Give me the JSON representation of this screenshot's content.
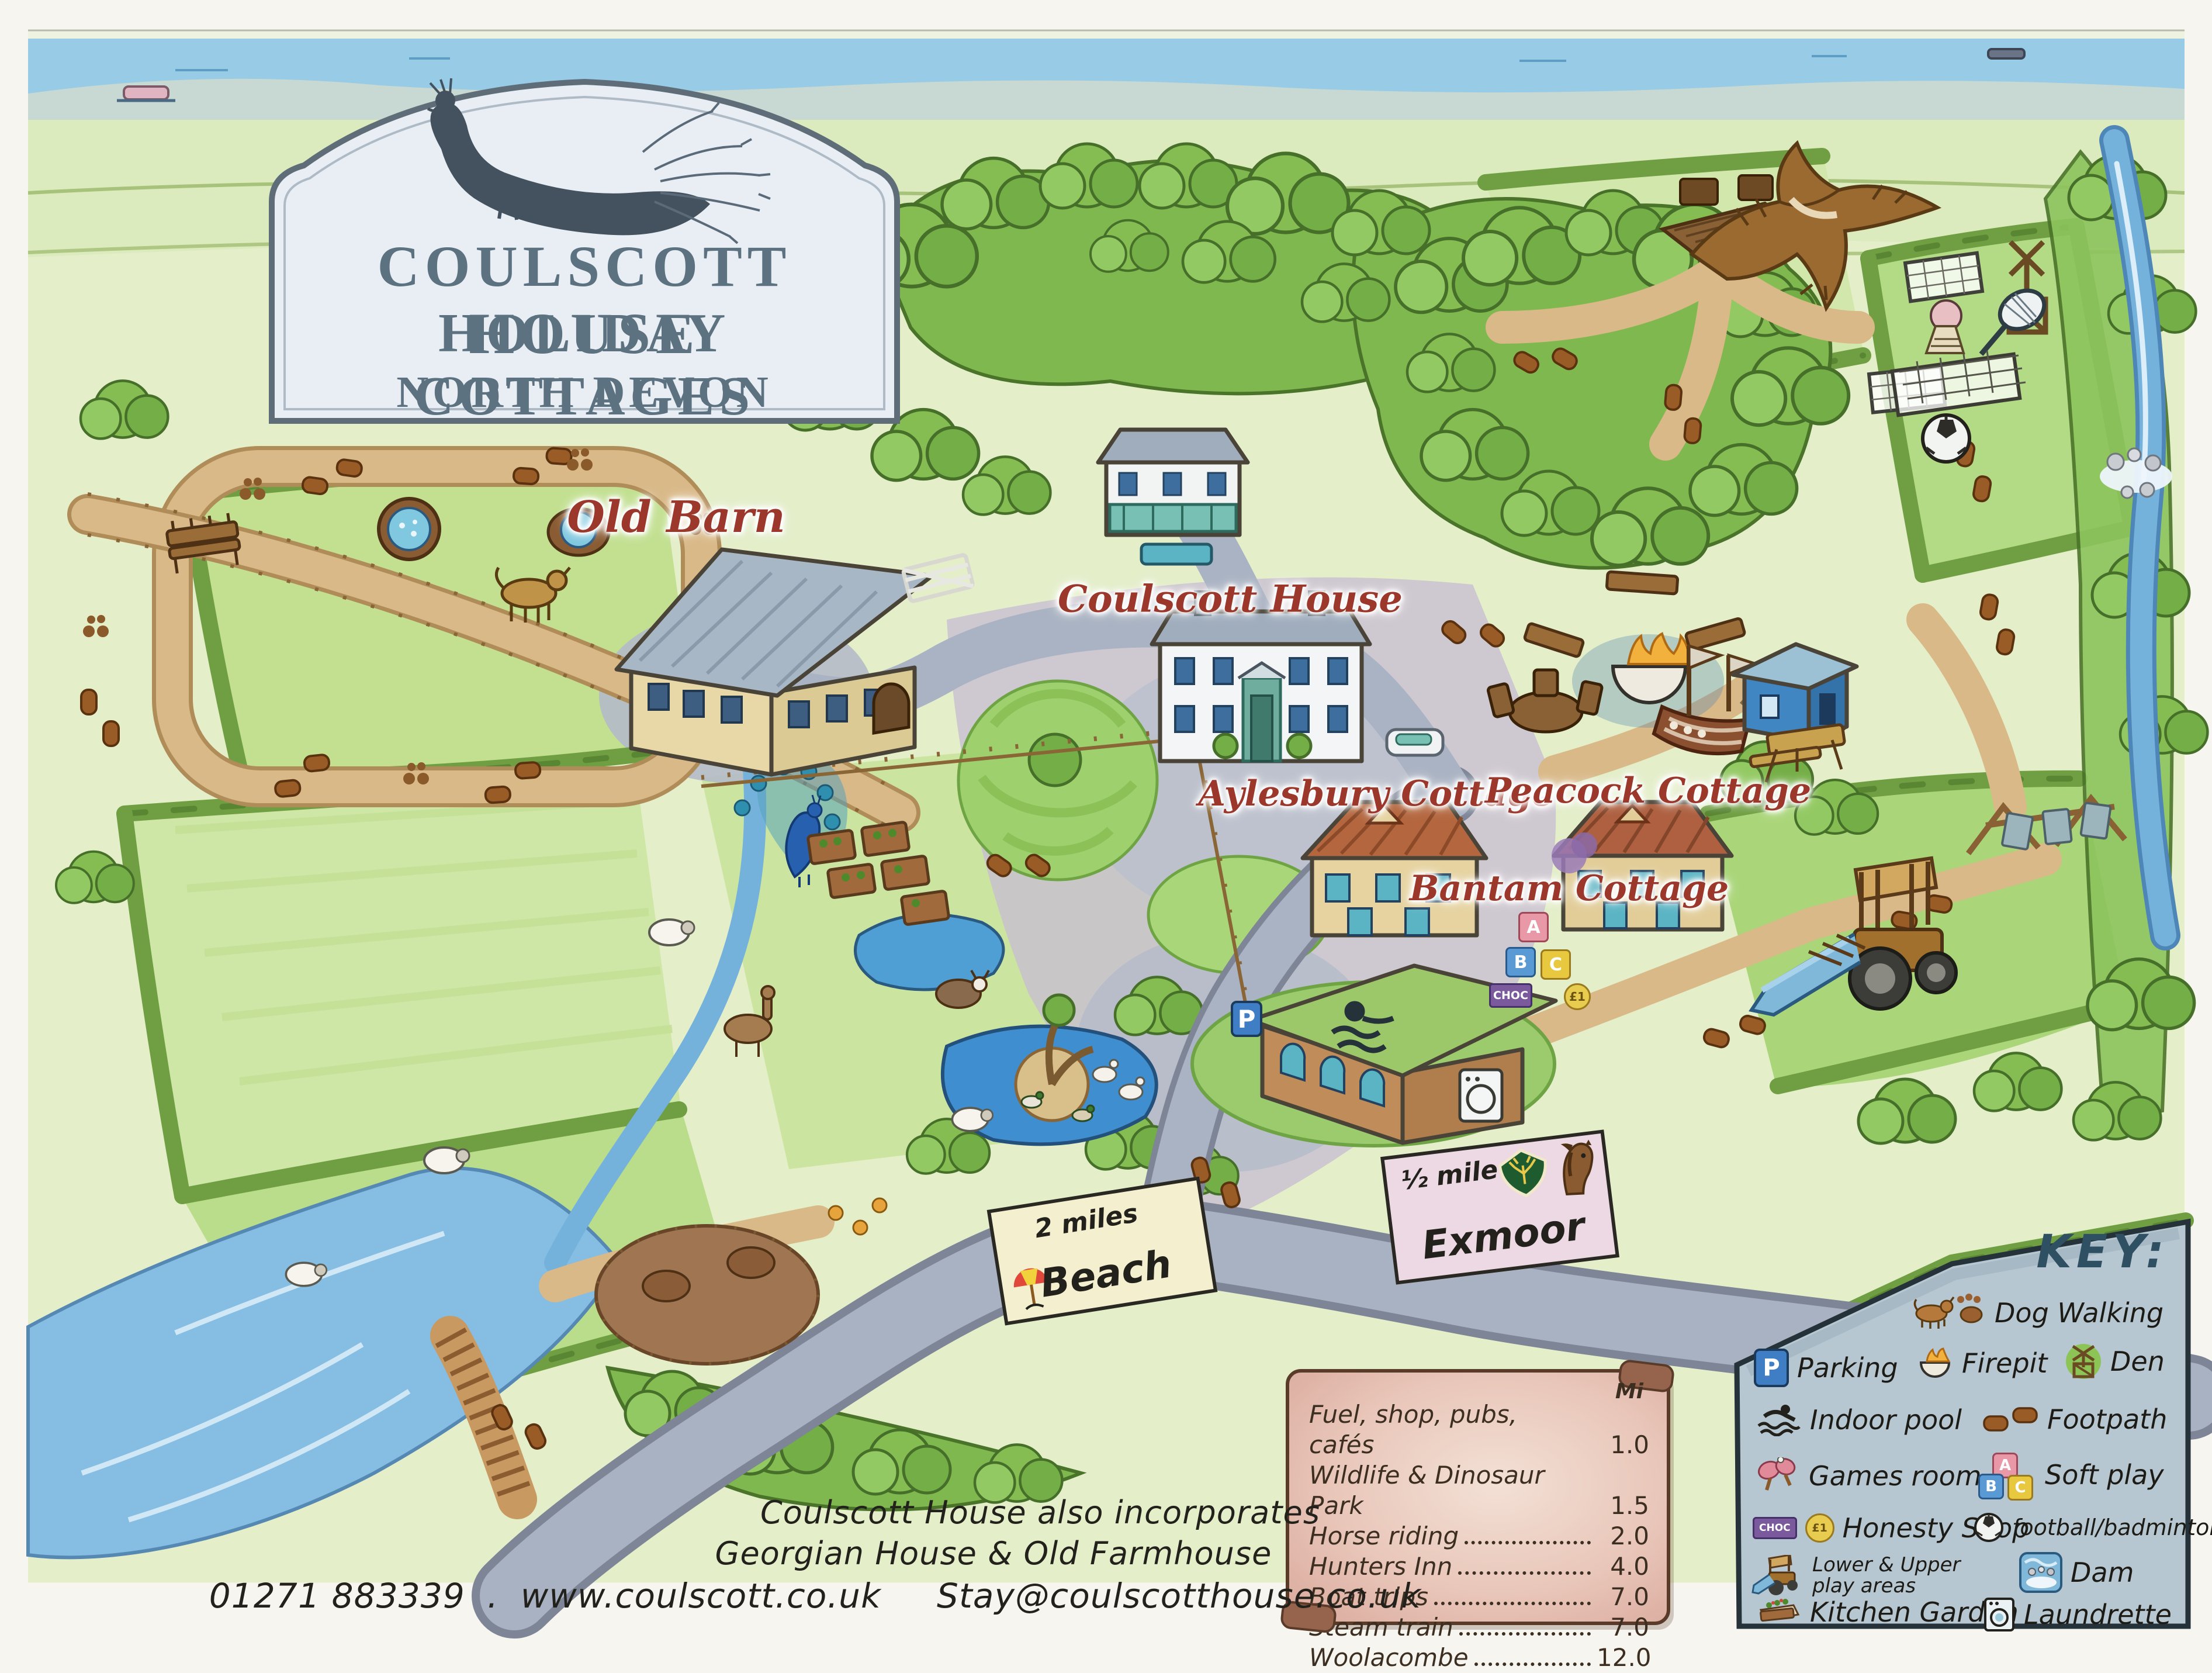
{
  "sign": {
    "title_line1": "COULSCOTT HOUSE",
    "title_line2": "HOLIDAY COTTAGES",
    "title_line3": "NORTH DEVON"
  },
  "map_labels": {
    "old_barn": "Old Barn",
    "coulscott_house": "Coulscott House",
    "aylesbury_cottage": "Aylesbury Cottage",
    "peacock_cottage": "Peacock Cottage",
    "bantam_cottage": "Bantam Cottage"
  },
  "road_signs": {
    "beach": {
      "distance": "2 miles",
      "name": "Beach"
    },
    "exmoor": {
      "distance": "½ mile",
      "name": "Exmoor"
    }
  },
  "map_marks": {
    "parking_letter": "P",
    "block_a": "A",
    "block_b": "B",
    "block_c": "C",
    "choc": "CHOC",
    "coin": "£1"
  },
  "distances": {
    "unit_header": "Mi",
    "items": [
      {
        "name": "Fuel, shop, pubs, cafés",
        "miles": "1.0"
      },
      {
        "name": "Wildlife & Dinosaur Park",
        "miles": "1.5"
      },
      {
        "name": "Horse riding",
        "miles": "2.0"
      },
      {
        "name": "Hunters Inn",
        "miles": "4.0"
      },
      {
        "name": "Boat trips",
        "miles": "7.0"
      },
      {
        "name": "Steam train",
        "miles": "7.0"
      },
      {
        "name": "Woolacombe",
        "miles": "12.0"
      }
    ]
  },
  "key": {
    "title": "KEY:",
    "items": [
      {
        "icon": "dog-walking-icon",
        "label": "Dog Walking"
      },
      {
        "icon": "parking-icon",
        "label": "Parking"
      },
      {
        "icon": "firepit-icon",
        "label": "Firepit"
      },
      {
        "icon": "den-icon",
        "label": "Den"
      },
      {
        "icon": "indoor-pool-icon",
        "label": "Indoor pool"
      },
      {
        "icon": "footpath-icon",
        "label": "Footpath"
      },
      {
        "icon": "games-room-icon",
        "label": "Games room"
      },
      {
        "icon": "soft-play-icon",
        "label": "Soft play"
      },
      {
        "icon": "honesty-shop-icon",
        "label": "Honesty Shop"
      },
      {
        "icon": "football-badminton-icon",
        "label": "football/badminton"
      },
      {
        "icon": "play-areas-icon",
        "label_line1": "Lower & Upper",
        "label_line2": "play areas"
      },
      {
        "icon": "dam-icon",
        "label": "Dam"
      },
      {
        "icon": "kitchen-garden-icon",
        "label": "Kitchen Garden"
      },
      {
        "icon": "laundrette-icon",
        "label": "Laundrette"
      }
    ]
  },
  "footer": {
    "incorporates_line1": "Coulscott House also incorporates",
    "incorporates_line2": "Georgian House & Old Farmhouse",
    "phone": "01271 883339",
    "separator": ".",
    "website": "www.coulscott.co.uk",
    "email": "Stay@coulscotthouse.co.uk"
  },
  "colors": {
    "label_red": "#9c372b",
    "sign_ink": "#5d7280",
    "key_panel": "#b6c7d1",
    "key_title_blue": "#2f4f63",
    "scroll_pink": "#e9c7ba",
    "parking_blue": "#3f7ec4"
  }
}
